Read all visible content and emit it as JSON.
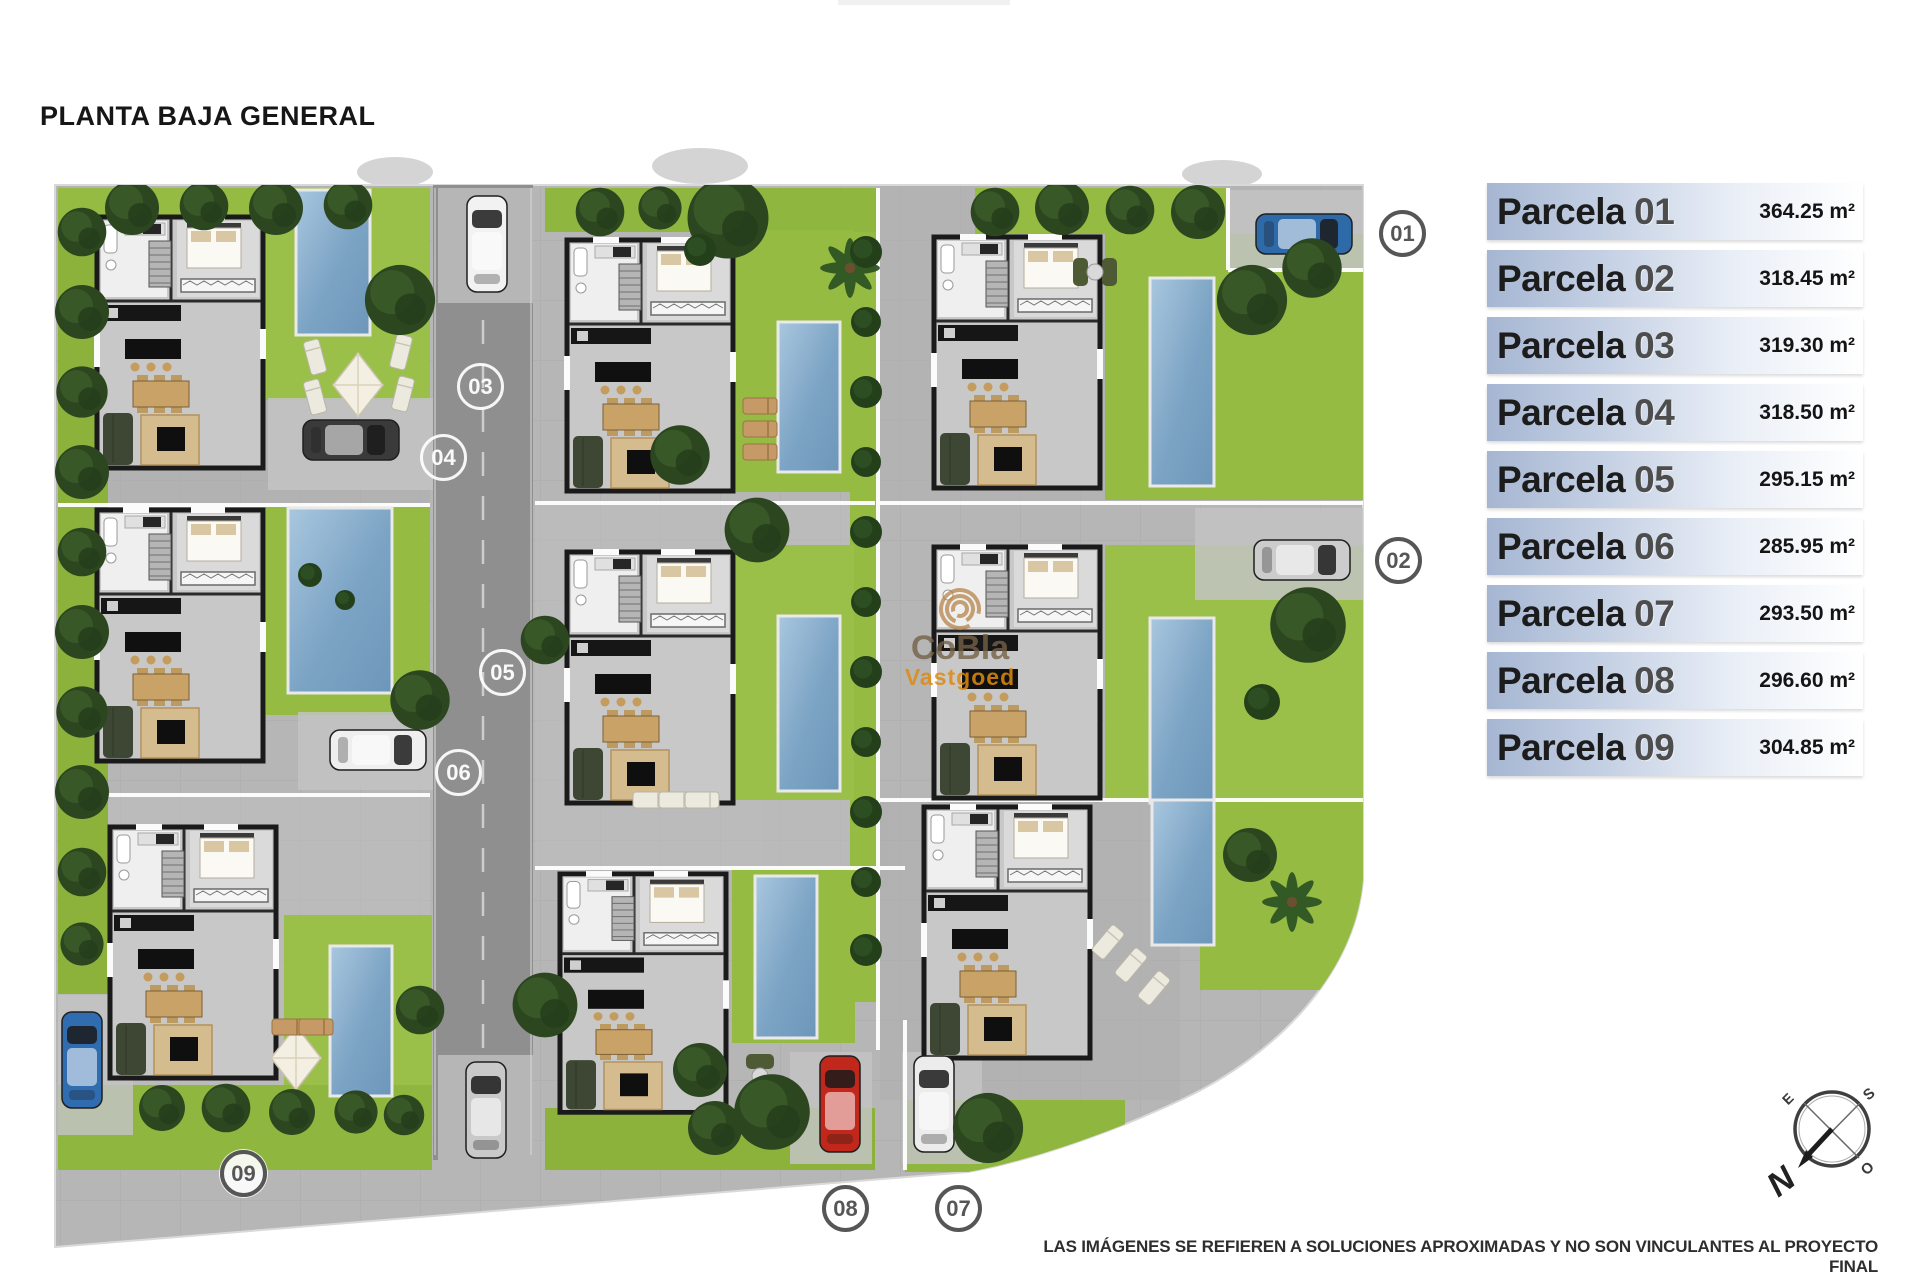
{
  "title": "PLANTA BAJA GENERAL",
  "legend": [
    {
      "label": "Parcela",
      "number": "01",
      "area": "364.25 m²"
    },
    {
      "label": "Parcela",
      "number": "02",
      "area": "318.45 m²"
    },
    {
      "label": "Parcela",
      "number": "03",
      "area": "319.30 m²"
    },
    {
      "label": "Parcela",
      "number": "04",
      "area": "318.50 m²"
    },
    {
      "label": "Parcela",
      "number": "05",
      "area": "295.15 m²"
    },
    {
      "label": "Parcela",
      "number": "06",
      "area": "285.95 m²"
    },
    {
      "label": "Parcela",
      "number": "07",
      "area": "293.50 m²"
    },
    {
      "label": "Parcela",
      "number": "08",
      "area": "296.60 m²"
    },
    {
      "label": "Parcela",
      "number": "09",
      "area": "304.85 m²"
    }
  ],
  "plan": {
    "markers": [
      "01",
      "02",
      "03",
      "04",
      "05",
      "06",
      "07",
      "08",
      "09"
    ]
  },
  "watermark": {
    "brand": "CoBla",
    "sub": "Vastgoed"
  },
  "compass": {
    "north": "N",
    "east": "E",
    "south": "S",
    "west": "O"
  },
  "disclaimer": "LAS IMÁGENES SE REFIEREN A SOLUCIONES APROXIMADAS Y NO SON VINCULANTES AL PROYECTO FINAL",
  "colors": {
    "legend_bar": "#a6b6d2",
    "grass": "#95bb43",
    "pool": "#7ba3c4",
    "road": "#8f8f8f",
    "paving": "#b6b6b6",
    "marker_dark": "#565656",
    "watermark_orange": "#de8a10"
  }
}
